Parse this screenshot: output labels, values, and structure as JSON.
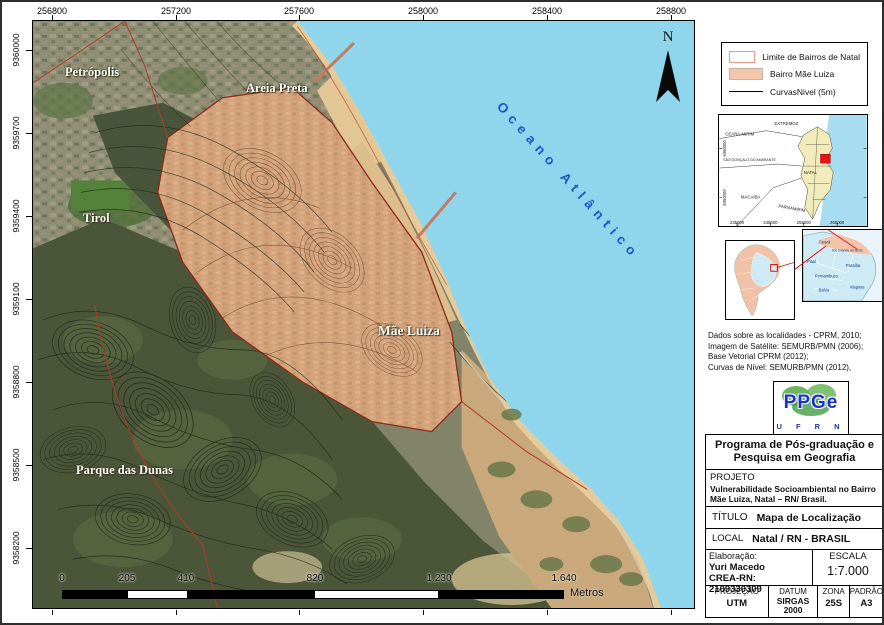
{
  "map": {
    "top_axis": [
      "256800",
      "257200",
      "257600",
      "258000",
      "258400",
      "258800"
    ],
    "left_axis": [
      "9360000",
      "9359700",
      "9359400",
      "9359100",
      "9358800",
      "9358500",
      "9358200"
    ],
    "places": {
      "petropolis": "Petrópolis",
      "areia_preta": "Areia Preta",
      "tirol": "Tirol",
      "mae_luiza": "Mãe Luiza",
      "parque_das_dunas": "Parque das Dunas"
    },
    "ocean_label": "Oceano Atlântico",
    "north_label": "N",
    "scalebar": {
      "labels": [
        "0",
        "205",
        "410",
        "820",
        "1.230",
        "1.640"
      ],
      "unit": "Metros"
    }
  },
  "legend": {
    "items": [
      {
        "label": "Limite de Bairros de Natal"
      },
      {
        "label": "Bairro Mãe Luiza"
      },
      {
        "label": "CurvasNivel (5m)"
      }
    ]
  },
  "inset_region": {
    "labels": {
      "ceara_mirim": "CEARÁ-MIRIM",
      "extremoz": "EXTREMOZ",
      "sao_goncalo": "SÃO GONÇALO DO AMARANTE",
      "natal": "NATAL",
      "macaiba": "MACAÍBA",
      "parnamirim": "PARNAMIRIM"
    },
    "x_axis": [
      "235000",
      "245000",
      "255000",
      "265000"
    ],
    "y_axis": [
      "9360000",
      "9350000"
    ]
  },
  "inset_states": {
    "labels": {
      "ceara": "Ceará",
      "rn": "Rio Grande do Norte",
      "piaui": "Piauí",
      "paraiba": "Paraíba",
      "pernambuco": "Pernambuco",
      "bahia": "Bahia",
      "alagoas": "Alagoas"
    }
  },
  "sources": {
    "line1": "Dados sobre as localidades - CPRM, 2010;",
    "line2": "Imagem de Satélite: SEMURB/PMN (2006);",
    "line3": "Base Vetorial CPRM (2012);",
    "line4": "Curvas de Nível: SEMURB/PMN (2012),"
  },
  "logo": {
    "main": "PPGe",
    "sub": "U F R N"
  },
  "title_block": {
    "program": "Programa de Pós-graduação e Pesquisa em Geografia",
    "projeto_label": "PROJETO",
    "projeto_value": "Vulnerabilidade Socioambiental no Bairro Mãe Luiza, Natal – RN/ Brasil.",
    "titulo_label": "TÍTULO",
    "titulo_value": "Mapa de Localização",
    "local_label": "LOCAL",
    "local_value": "Natal / RN - BRASIL",
    "elaboracao_label": "Elaboração:",
    "elaboracao_name": "Yuri Macedo",
    "elaboracao_crea": "CREA-RN: 2109330309",
    "escala_label": "ESCALA",
    "escala_value": "1:7.000",
    "projecao_label": "PROJEÇÃO",
    "projecao_value": "UTM",
    "datum_label": "DATUM",
    "datum_value": "SIRGAS 2000",
    "zona_label": "ZONA",
    "zona_value": "25S",
    "padrao_label": "PADRÃO",
    "padrao_value": "A3"
  },
  "colors": {
    "ocean": "#8fd6ec",
    "bairro_fill": "#f4c7ad",
    "bairro_outline": "#8c2a1c",
    "boundary_red": "#b23a28",
    "ocean_text": "#1e56c9"
  }
}
